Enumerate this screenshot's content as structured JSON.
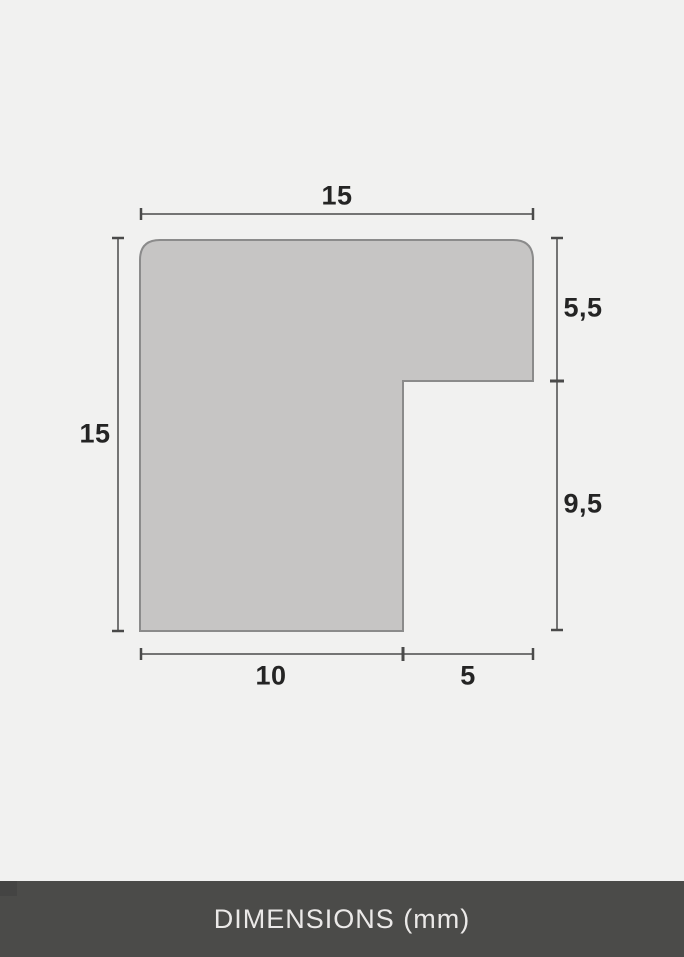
{
  "diagram": {
    "type": "frame-moulding-profile-cross-section",
    "unit": "mm",
    "dimensions": {
      "top_width": "15",
      "left_height": "15",
      "right_upper_height": "5,5",
      "right_lower_height": "9,5",
      "bottom_left_width": "10",
      "bottom_right_width": "5"
    },
    "profile_values_mm": {
      "total_width": 15,
      "total_height": 15,
      "right_lip_depth": 5.5,
      "rabbet_height": 9.5,
      "body_width": 10,
      "rabbet_width": 5
    },
    "colors": {
      "background": "#f1f1f0",
      "shape_fill": "#c6c5c4",
      "shape_stroke": "#8b8b8b",
      "dimension_line": "#4a4a4a",
      "dimension_text": "#242424"
    }
  },
  "footer": {
    "label": "DIMENSIONS (mm)",
    "background": "#4b4b49",
    "text_color": "#ebe9e8"
  }
}
